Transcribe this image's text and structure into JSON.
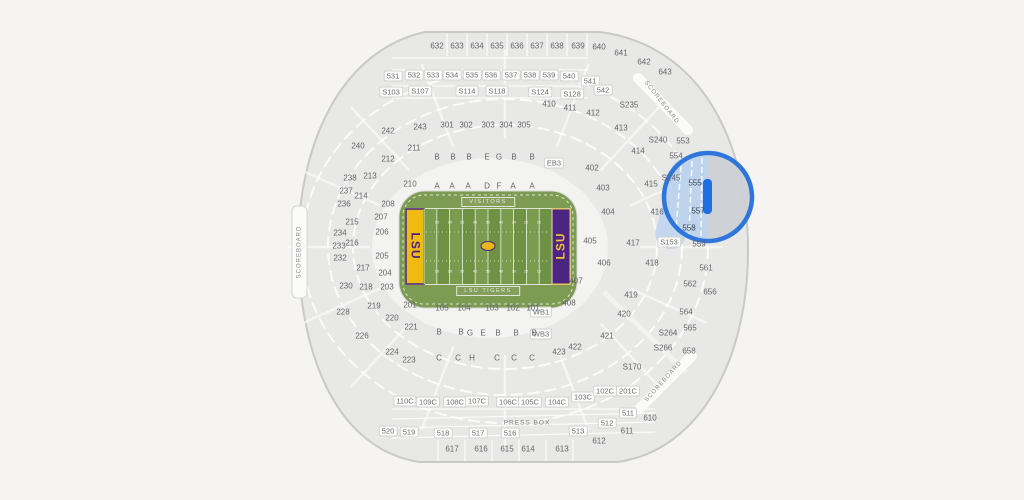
{
  "map": {
    "title": "Tiger Stadium seating map",
    "colors": {
      "page_bg": "#f5f4f2",
      "bowl_fill": "#e8e8e6",
      "bowl_stroke": "#c9c9c7",
      "concourse_fill": "#f3f3f1",
      "tab_fill": "#fbfbf9",
      "tab_stroke": "#d5d5d3",
      "apron_green": "#7d9b52",
      "stripe_light": "#7b9c4f",
      "stripe_dark": "#6f9143",
      "endzone_left_bg": "#efbb10",
      "endzone_left_text": "#4a2380",
      "endzone_right_bg": "#4c2481",
      "endzone_right_text": "#f3c33b",
      "logo_gold": "#e8b71a",
      "highlight_ring": "#2e76dc",
      "highlight_bar": "#1d6ee0",
      "highlight_tint": "#bdd4ef",
      "highlight_disc": "#ccd0d4"
    },
    "highlight": {
      "section": "557"
    },
    "field": {
      "visitors_label": "VISITORS",
      "home_label": "LSU TIGERS",
      "endzone_text": "LSU",
      "yard_values": [
        "10",
        "20",
        "30",
        "40",
        "50",
        "40",
        "30",
        "20",
        "10"
      ]
    },
    "labels": [
      {
        "t": "632",
        "x": 437,
        "y": 46
      },
      {
        "t": "633",
        "x": 457,
        "y": 46
      },
      {
        "t": "634",
        "x": 477,
        "y": 46
      },
      {
        "t": "635",
        "x": 497,
        "y": 46
      },
      {
        "t": "636",
        "x": 517,
        "y": 46
      },
      {
        "t": "637",
        "x": 537,
        "y": 46
      },
      {
        "t": "638",
        "x": 557,
        "y": 46
      },
      {
        "t": "639",
        "x": 578,
        "y": 46
      },
      {
        "t": "640",
        "x": 599,
        "y": 47
      },
      {
        "t": "641",
        "x": 621,
        "y": 53
      },
      {
        "t": "642",
        "x": 644,
        "y": 62
      },
      {
        "t": "643",
        "x": 665,
        "y": 72
      },
      {
        "t": "531",
        "x": 393,
        "y": 76,
        "cls": "box"
      },
      {
        "t": "532",
        "x": 414,
        "y": 75,
        "cls": "box"
      },
      {
        "t": "533",
        "x": 433,
        "y": 75,
        "cls": "box"
      },
      {
        "t": "534",
        "x": 452,
        "y": 75,
        "cls": "box"
      },
      {
        "t": "535",
        "x": 472,
        "y": 75,
        "cls": "box"
      },
      {
        "t": "536",
        "x": 491,
        "y": 75,
        "cls": "box"
      },
      {
        "t": "537",
        "x": 511,
        "y": 75,
        "cls": "box"
      },
      {
        "t": "538",
        "x": 530,
        "y": 75,
        "cls": "box"
      },
      {
        "t": "539",
        "x": 549,
        "y": 75,
        "cls": "box"
      },
      {
        "t": "540",
        "x": 569,
        "y": 76,
        "cls": "box"
      },
      {
        "t": "541",
        "x": 590,
        "y": 81,
        "cls": "box"
      },
      {
        "t": "542",
        "x": 603,
        "y": 90,
        "cls": "box"
      },
      {
        "t": "S103",
        "x": 391,
        "y": 92,
        "cls": "box"
      },
      {
        "t": "S107",
        "x": 420,
        "y": 91,
        "cls": "box"
      },
      {
        "t": "S114",
        "x": 467,
        "y": 91,
        "cls": "box"
      },
      {
        "t": "S118",
        "x": 497,
        "y": 91,
        "cls": "box"
      },
      {
        "t": "S124",
        "x": 540,
        "y": 92,
        "cls": "box"
      },
      {
        "t": "S128",
        "x": 572,
        "y": 94,
        "cls": "box"
      },
      {
        "t": "S235",
        "x": 629,
        "y": 105
      },
      {
        "t": "S240",
        "x": 658,
        "y": 140
      },
      {
        "t": "553",
        "x": 683,
        "y": 141
      },
      {
        "t": "554",
        "x": 676,
        "y": 156
      },
      {
        "t": "S245",
        "x": 671,
        "y": 178
      },
      {
        "t": "555",
        "x": 695,
        "y": 183,
        "cls": "hl"
      },
      {
        "t": "557",
        "x": 698,
        "y": 211,
        "cls": "hl"
      },
      {
        "t": "558",
        "x": 689,
        "y": 228,
        "cls": "hl"
      },
      {
        "t": "559",
        "x": 699,
        "y": 244
      },
      {
        "t": "S153",
        "x": 669,
        "y": 242,
        "cls": "box"
      },
      {
        "t": "561",
        "x": 706,
        "y": 268
      },
      {
        "t": "562",
        "x": 690,
        "y": 284
      },
      {
        "t": "656",
        "x": 710,
        "y": 292
      },
      {
        "t": "564",
        "x": 686,
        "y": 312
      },
      {
        "t": "565",
        "x": 690,
        "y": 328
      },
      {
        "t": "658",
        "x": 689,
        "y": 351
      },
      {
        "t": "S264",
        "x": 668,
        "y": 333
      },
      {
        "t": "S266",
        "x": 663,
        "y": 348
      },
      {
        "t": "S170",
        "x": 632,
        "y": 367
      },
      {
        "t": "410",
        "x": 549,
        "y": 104
      },
      {
        "t": "411",
        "x": 570,
        "y": 108
      },
      {
        "t": "412",
        "x": 593,
        "y": 113
      },
      {
        "t": "413",
        "x": 621,
        "y": 128
      },
      {
        "t": "414",
        "x": 638,
        "y": 151
      },
      {
        "t": "415",
        "x": 651,
        "y": 184
      },
      {
        "t": "402",
        "x": 592,
        "y": 168
      },
      {
        "t": "403",
        "x": 603,
        "y": 188
      },
      {
        "t": "404",
        "x": 608,
        "y": 212
      },
      {
        "t": "405",
        "x": 590,
        "y": 241
      },
      {
        "t": "406",
        "x": 604,
        "y": 263
      },
      {
        "t": "416",
        "x": 657,
        "y": 212
      },
      {
        "t": "417",
        "x": 633,
        "y": 243
      },
      {
        "t": "418",
        "x": 652,
        "y": 263
      },
      {
        "t": "407",
        "x": 576,
        "y": 281
      },
      {
        "t": "408",
        "x": 569,
        "y": 303
      },
      {
        "t": "419",
        "x": 631,
        "y": 295
      },
      {
        "t": "420",
        "x": 624,
        "y": 314
      },
      {
        "t": "421",
        "x": 607,
        "y": 336
      },
      {
        "t": "422",
        "x": 575,
        "y": 347
      },
      {
        "t": "423",
        "x": 559,
        "y": 352
      },
      {
        "t": "EB3",
        "x": 554,
        "y": 163,
        "cls": "box"
      },
      {
        "t": "WB1",
        "x": 541,
        "y": 312,
        "cls": "box"
      },
      {
        "t": "WB3",
        "x": 541,
        "y": 334,
        "cls": "box"
      },
      {
        "t": "301",
        "x": 447,
        "y": 125
      },
      {
        "t": "302",
        "x": 466,
        "y": 125
      },
      {
        "t": "303",
        "x": 488,
        "y": 125
      },
      {
        "t": "304",
        "x": 506,
        "y": 125
      },
      {
        "t": "305",
        "x": 524,
        "y": 125
      },
      {
        "t": "B",
        "x": 437,
        "y": 157
      },
      {
        "t": "B",
        "x": 453,
        "y": 157
      },
      {
        "t": "B",
        "x": 469,
        "y": 157
      },
      {
        "t": "E",
        "x": 487,
        "y": 157
      },
      {
        "t": "G",
        "x": 499,
        "y": 157
      },
      {
        "t": "B",
        "x": 514,
        "y": 157
      },
      {
        "t": "B",
        "x": 532,
        "y": 157
      },
      {
        "t": "A",
        "x": 437,
        "y": 186
      },
      {
        "t": "A",
        "x": 452,
        "y": 186
      },
      {
        "t": "A",
        "x": 468,
        "y": 186
      },
      {
        "t": "D",
        "x": 487,
        "y": 186
      },
      {
        "t": "F",
        "x": 499,
        "y": 186
      },
      {
        "t": "A",
        "x": 513,
        "y": 186
      },
      {
        "t": "A",
        "x": 532,
        "y": 186
      },
      {
        "t": "105",
        "x": 442,
        "y": 308
      },
      {
        "t": "104",
        "x": 464,
        "y": 308
      },
      {
        "t": "103",
        "x": 492,
        "y": 308
      },
      {
        "t": "102",
        "x": 513,
        "y": 308
      },
      {
        "t": "101",
        "x": 533,
        "y": 308
      },
      {
        "t": "B",
        "x": 439,
        "y": 332
      },
      {
        "t": "B",
        "x": 461,
        "y": 332
      },
      {
        "t": "G",
        "x": 470,
        "y": 333
      },
      {
        "t": "E",
        "x": 483,
        "y": 333
      },
      {
        "t": "B",
        "x": 498,
        "y": 333
      },
      {
        "t": "B",
        "x": 516,
        "y": 333
      },
      {
        "t": "B",
        "x": 534,
        "y": 333
      },
      {
        "t": "C",
        "x": 439,
        "y": 358
      },
      {
        "t": "C",
        "x": 458,
        "y": 358
      },
      {
        "t": "H",
        "x": 472,
        "y": 358
      },
      {
        "t": "C",
        "x": 497,
        "y": 358
      },
      {
        "t": "C",
        "x": 514,
        "y": 358
      },
      {
        "t": "C",
        "x": 532,
        "y": 358
      },
      {
        "t": "240",
        "x": 358,
        "y": 146
      },
      {
        "t": "242",
        "x": 388,
        "y": 131
      },
      {
        "t": "243",
        "x": 420,
        "y": 127
      },
      {
        "t": "211",
        "x": 414,
        "y": 148
      },
      {
        "t": "212",
        "x": 388,
        "y": 159
      },
      {
        "t": "213",
        "x": 370,
        "y": 176
      },
      {
        "t": "214",
        "x": 361,
        "y": 196
      },
      {
        "t": "215",
        "x": 352,
        "y": 222
      },
      {
        "t": "216",
        "x": 352,
        "y": 243
      },
      {
        "t": "210",
        "x": 410,
        "y": 184
      },
      {
        "t": "208",
        "x": 388,
        "y": 204
      },
      {
        "t": "207",
        "x": 381,
        "y": 217
      },
      {
        "t": "206",
        "x": 382,
        "y": 232
      },
      {
        "t": "205",
        "x": 382,
        "y": 256
      },
      {
        "t": "217",
        "x": 363,
        "y": 268
      },
      {
        "t": "204",
        "x": 385,
        "y": 273
      },
      {
        "t": "218",
        "x": 366,
        "y": 287
      },
      {
        "t": "203",
        "x": 387,
        "y": 287
      },
      {
        "t": "219",
        "x": 374,
        "y": 306
      },
      {
        "t": "201",
        "x": 410,
        "y": 305
      },
      {
        "t": "220",
        "x": 392,
        "y": 318
      },
      {
        "t": "221",
        "x": 411,
        "y": 327
      },
      {
        "t": "228",
        "x": 343,
        "y": 312
      },
      {
        "t": "226",
        "x": 362,
        "y": 336
      },
      {
        "t": "224",
        "x": 392,
        "y": 352
      },
      {
        "t": "223",
        "x": 409,
        "y": 360
      },
      {
        "t": "238",
        "x": 350,
        "y": 178
      },
      {
        "t": "237",
        "x": 346,
        "y": 191
      },
      {
        "t": "236",
        "x": 344,
        "y": 204
      },
      {
        "t": "234",
        "x": 340,
        "y": 233
      },
      {
        "t": "233",
        "x": 339,
        "y": 246
      },
      {
        "t": "232",
        "x": 340,
        "y": 258
      },
      {
        "t": "230",
        "x": 346,
        "y": 286
      },
      {
        "t": "110C",
        "x": 405,
        "y": 401,
        "cls": "box"
      },
      {
        "t": "109C",
        "x": 428,
        "y": 402,
        "cls": "box"
      },
      {
        "t": "108C",
        "x": 455,
        "y": 402,
        "cls": "box"
      },
      {
        "t": "107C",
        "x": 477,
        "y": 401,
        "cls": "box"
      },
      {
        "t": "106C",
        "x": 508,
        "y": 402,
        "cls": "box"
      },
      {
        "t": "105C",
        "x": 530,
        "y": 402,
        "cls": "box"
      },
      {
        "t": "104C",
        "x": 557,
        "y": 402,
        "cls": "box"
      },
      {
        "t": "103C",
        "x": 583,
        "y": 397,
        "cls": "box"
      },
      {
        "t": "102C",
        "x": 605,
        "y": 391,
        "cls": "box"
      },
      {
        "t": "201C",
        "x": 628,
        "y": 391,
        "cls": "box"
      },
      {
        "t": "520",
        "x": 388,
        "y": 431,
        "cls": "box"
      },
      {
        "t": "519",
        "x": 409,
        "y": 432,
        "cls": "box"
      },
      {
        "t": "518",
        "x": 443,
        "y": 433,
        "cls": "box"
      },
      {
        "t": "517",
        "x": 478,
        "y": 433,
        "cls": "box"
      },
      {
        "t": "516",
        "x": 510,
        "y": 433,
        "cls": "box"
      },
      {
        "t": "513",
        "x": 578,
        "y": 431,
        "cls": "box"
      },
      {
        "t": "512",
        "x": 607,
        "y": 423,
        "cls": "box"
      },
      {
        "t": "511",
        "x": 628,
        "y": 413,
        "cls": "box"
      },
      {
        "t": "617",
        "x": 452,
        "y": 449
      },
      {
        "t": "616",
        "x": 481,
        "y": 449
      },
      {
        "t": "615",
        "x": 507,
        "y": 449
      },
      {
        "t": "614",
        "x": 528,
        "y": 449
      },
      {
        "t": "613",
        "x": 562,
        "y": 449
      },
      {
        "t": "612",
        "x": 599,
        "y": 441
      },
      {
        "t": "611",
        "x": 627,
        "y": 431
      },
      {
        "t": "610",
        "x": 650,
        "y": 418
      },
      {
        "t": "PRESS BOX",
        "x": 527,
        "y": 423,
        "cls": "pb",
        "i": false,
        "n": "press-box-label"
      },
      {
        "t": "SCOREBOARD",
        "x": 300,
        "y": 252,
        "cls": "sb",
        "r": -90,
        "i": false,
        "n": "scoreboard-west-label"
      },
      {
        "t": "SCOREBOARD",
        "x": 661,
        "y": 103,
        "cls": "sb",
        "r": 52,
        "i": false,
        "n": "scoreboard-northeast-label"
      },
      {
        "t": "SCOREBOARD",
        "x": 664,
        "y": 382,
        "cls": "sb",
        "r": -48,
        "i": false,
        "n": "scoreboard-southeast-label"
      },
      {
        "t": "VISITORS",
        "x": 488,
        "y": 202,
        "cls": "fieldtag",
        "i": false,
        "n": "visitors-bench-label"
      },
      {
        "t": "LSU TIGERS",
        "x": 488,
        "y": 291,
        "cls": "fieldtag",
        "i": false,
        "n": "home-bench-label"
      },
      {
        "t": "LSU",
        "x": 415,
        "y": 246,
        "cls": "ez ezl",
        "r": 90,
        "i": false,
        "n": "endzone-left-text"
      },
      {
        "t": "LSU",
        "x": 561,
        "y": 246,
        "cls": "ez ezr",
        "r": -90,
        "i": false,
        "n": "endzone-right-text"
      },
      {
        "t": "10",
        "x": 437,
        "y": 222,
        "cls": "yard",
        "i": false,
        "n": "yard-number"
      },
      {
        "t": "20",
        "x": 450,
        "y": 222,
        "cls": "yard",
        "i": false,
        "n": "yard-number"
      },
      {
        "t": "30",
        "x": 462,
        "y": 222,
        "cls": "yard",
        "i": false,
        "n": "yard-number"
      },
      {
        "t": "40",
        "x": 475,
        "y": 222,
        "cls": "yard",
        "i": false,
        "n": "yard-number"
      },
      {
        "t": "50",
        "x": 488,
        "y": 222,
        "cls": "yard",
        "i": false,
        "n": "yard-number"
      },
      {
        "t": "40",
        "x": 501,
        "y": 222,
        "cls": "yard",
        "i": false,
        "n": "yard-number"
      },
      {
        "t": "30",
        "x": 514,
        "y": 222,
        "cls": "yard",
        "i": false,
        "n": "yard-number"
      },
      {
        "t": "20",
        "x": 526,
        "y": 222,
        "cls": "yard",
        "i": false,
        "n": "yard-number"
      },
      {
        "t": "10",
        "x": 539,
        "y": 222,
        "cls": "yard",
        "i": false,
        "n": "yard-number"
      },
      {
        "t": "10",
        "x": 437,
        "y": 271,
        "cls": "yard",
        "i": false,
        "n": "yard-number"
      },
      {
        "t": "20",
        "x": 450,
        "y": 271,
        "cls": "yard",
        "i": false,
        "n": "yard-number"
      },
      {
        "t": "30",
        "x": 462,
        "y": 271,
        "cls": "yard",
        "i": false,
        "n": "yard-number"
      },
      {
        "t": "40",
        "x": 475,
        "y": 271,
        "cls": "yard",
        "i": false,
        "n": "yard-number"
      },
      {
        "t": "50",
        "x": 488,
        "y": 271,
        "cls": "yard",
        "i": false,
        "n": "yard-number"
      },
      {
        "t": "40",
        "x": 501,
        "y": 271,
        "cls": "yard",
        "i": false,
        "n": "yard-number"
      },
      {
        "t": "30",
        "x": 514,
        "y": 271,
        "cls": "yard",
        "i": false,
        "n": "yard-number"
      },
      {
        "t": "20",
        "x": 526,
        "y": 271,
        "cls": "yard",
        "i": false,
        "n": "yard-number"
      },
      {
        "t": "10",
        "x": 539,
        "y": 271,
        "cls": "yard",
        "i": false,
        "n": "yard-number"
      }
    ]
  }
}
